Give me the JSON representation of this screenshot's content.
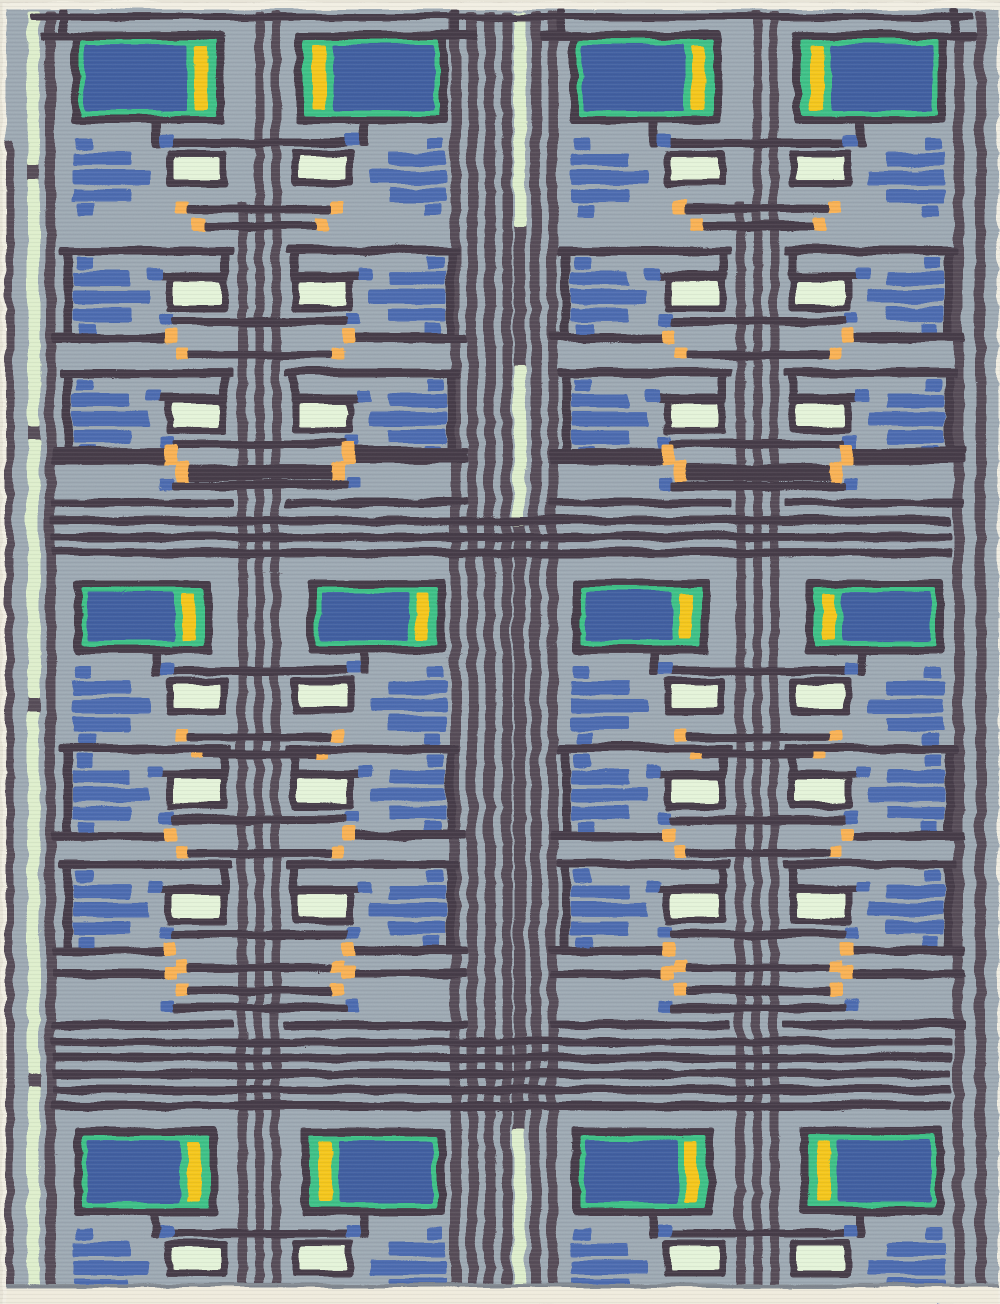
{
  "image": {
    "kind": "photograph",
    "subject": "flat-weave kilim rug with Frank Lloyd Wright style geometric pattern",
    "alt": "Gray-blue rug with dark plum maze lines, blue panels bordered in green with yellow stripes, stacked blue bars, pale mint rectangles and small orange square terminals, arranged in four mirrored columns and three bands"
  },
  "palette": {
    "page_bg": "#e7e3d6",
    "selvedge": "#f1eee2",
    "rug_bg": "#9ba7b1",
    "line": "#443a46",
    "stripe": "#554b57",
    "blue_panel": "#415d9e",
    "blue_bar": "#4c69ae",
    "green": "#3dc084",
    "yellow": "#f4c51d",
    "mint": "#e4f3d8",
    "mint_stripe": "#ddeecb",
    "orange": "#f9b052",
    "fringe": "#efebdc",
    "shadow": "#7e858d"
  },
  "layout": {
    "width": 1000,
    "height": 1304,
    "col_width": 168,
    "pair_axes": [
      258,
      756
    ],
    "bands": [
      {
        "y": 30,
        "fx": 8,
        "fw": 152,
        "fh": 92,
        "stack": 104,
        "t2": 215,
        "pitch": 122,
        "zone": 416
      },
      {
        "y": 578,
        "fx": 10,
        "fw": 138,
        "fh": 74,
        "stack": 84,
        "t2": 165,
        "pitch": 115,
        "zone": 390
      },
      {
        "y": 1126,
        "fx": 10,
        "fw": 144,
        "fh": 88,
        "stack": 98
      }
    ],
    "panel_flips": [
      [
        "R",
        "L",
        "R",
        "L"
      ],
      [
        "R",
        "R",
        "R",
        "L"
      ],
      [
        "R",
        "L",
        "R",
        "L"
      ]
    ],
    "top_line": {
      "y": 12,
      "x1": 28,
      "x2": 972
    },
    "dividers": [
      {
        "x1": 50,
        "x2": 950,
        "ys": [
          515,
          531,
          547
        ]
      },
      {
        "x1": 50,
        "x2": 950,
        "ys": [
          1036,
          1052,
          1068,
          1084,
          1100
        ]
      }
    ],
    "spines": [
      {
        "x": 3,
        "w": 9,
        "y1": 140,
        "y2": 1284
      },
      {
        "x": 26,
        "w": 12,
        "y1": 10,
        "y2": 1284
      },
      {
        "x": 44,
        "w": 10,
        "y1": 10,
        "y2": 1284
      },
      {
        "x": 236,
        "w": 9,
        "y1": 200,
        "y2": 1284
      },
      {
        "x": 253,
        "w": 9,
        "y1": 10,
        "y2": 1284
      },
      {
        "x": 270,
        "w": 9,
        "y1": 10,
        "y2": 1284
      },
      {
        "x": 449,
        "w": 10,
        "y1": 10,
        "y2": 1284
      },
      {
        "x": 466,
        "w": 10,
        "y1": 10,
        "y2": 1284
      },
      {
        "x": 483,
        "w": 10,
        "y1": 10,
        "y2": 1284
      },
      {
        "x": 500,
        "w": 10,
        "y1": 10,
        "y2": 1284
      },
      {
        "x": 512,
        "w": 12,
        "y1": 10,
        "y2": 1284
      },
      {
        "x": 529,
        "w": 10,
        "y1": 10,
        "y2": 1284
      },
      {
        "x": 546,
        "w": 10,
        "y1": 10,
        "y2": 1284
      },
      {
        "x": 734,
        "w": 9,
        "y1": 200,
        "y2": 1284
      },
      {
        "x": 751,
        "w": 9,
        "y1": 10,
        "y2": 1284
      },
      {
        "x": 768,
        "w": 9,
        "y1": 10,
        "y2": 1284
      },
      {
        "x": 952,
        "w": 10,
        "y1": 30,
        "y2": 1284
      },
      {
        "x": 974,
        "w": 10,
        "y1": 10,
        "y2": 1284
      }
    ],
    "mint_stripes": [
      {
        "x": 26,
        "w": 12,
        "segments": [
          [
            10,
            164
          ],
          [
            178,
            424
          ],
          [
            438,
            698
          ],
          [
            712,
            1072
          ],
          [
            1086,
            1284
          ]
        ]
      },
      {
        "x": 512,
        "w": 12,
        "segments": [
          [
            10,
            224
          ],
          [
            364,
            524
          ],
          [
            1128,
            1284
          ]
        ]
      }
    ],
    "fringe": {
      "y": 1286,
      "h": 18
    }
  }
}
